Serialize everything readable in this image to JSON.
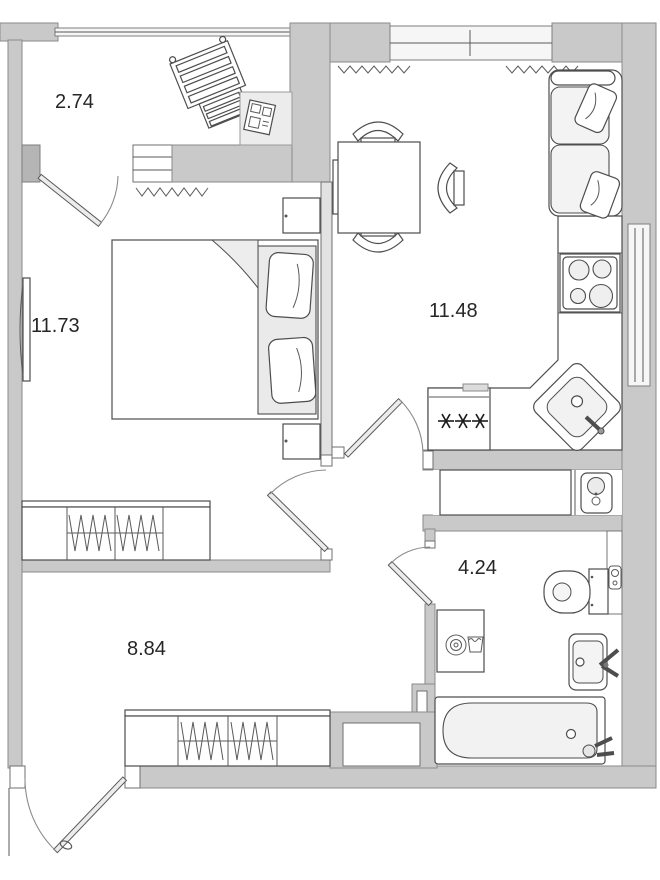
{
  "floorplan": {
    "rooms": [
      {
        "name": "balcony",
        "area_label": "2.74"
      },
      {
        "name": "bedroom",
        "area_label": "11.73"
      },
      {
        "name": "kitchen-living-room",
        "area_label": "11.48"
      },
      {
        "name": "hallway",
        "area_label": "8.84"
      },
      {
        "name": "bathroom",
        "area_label": "4.24"
      }
    ],
    "colors": {
      "wall_fill": "#c9c9c9",
      "wall_stroke": "#8a8a8a",
      "partition_fill": "#e2e2e2",
      "furniture_stroke": "#4d4d4d",
      "soft_fill": "#efefef",
      "window_fill": "#f6f6f6",
      "label_text": "#262626",
      "paper": "#ffffff"
    }
  }
}
